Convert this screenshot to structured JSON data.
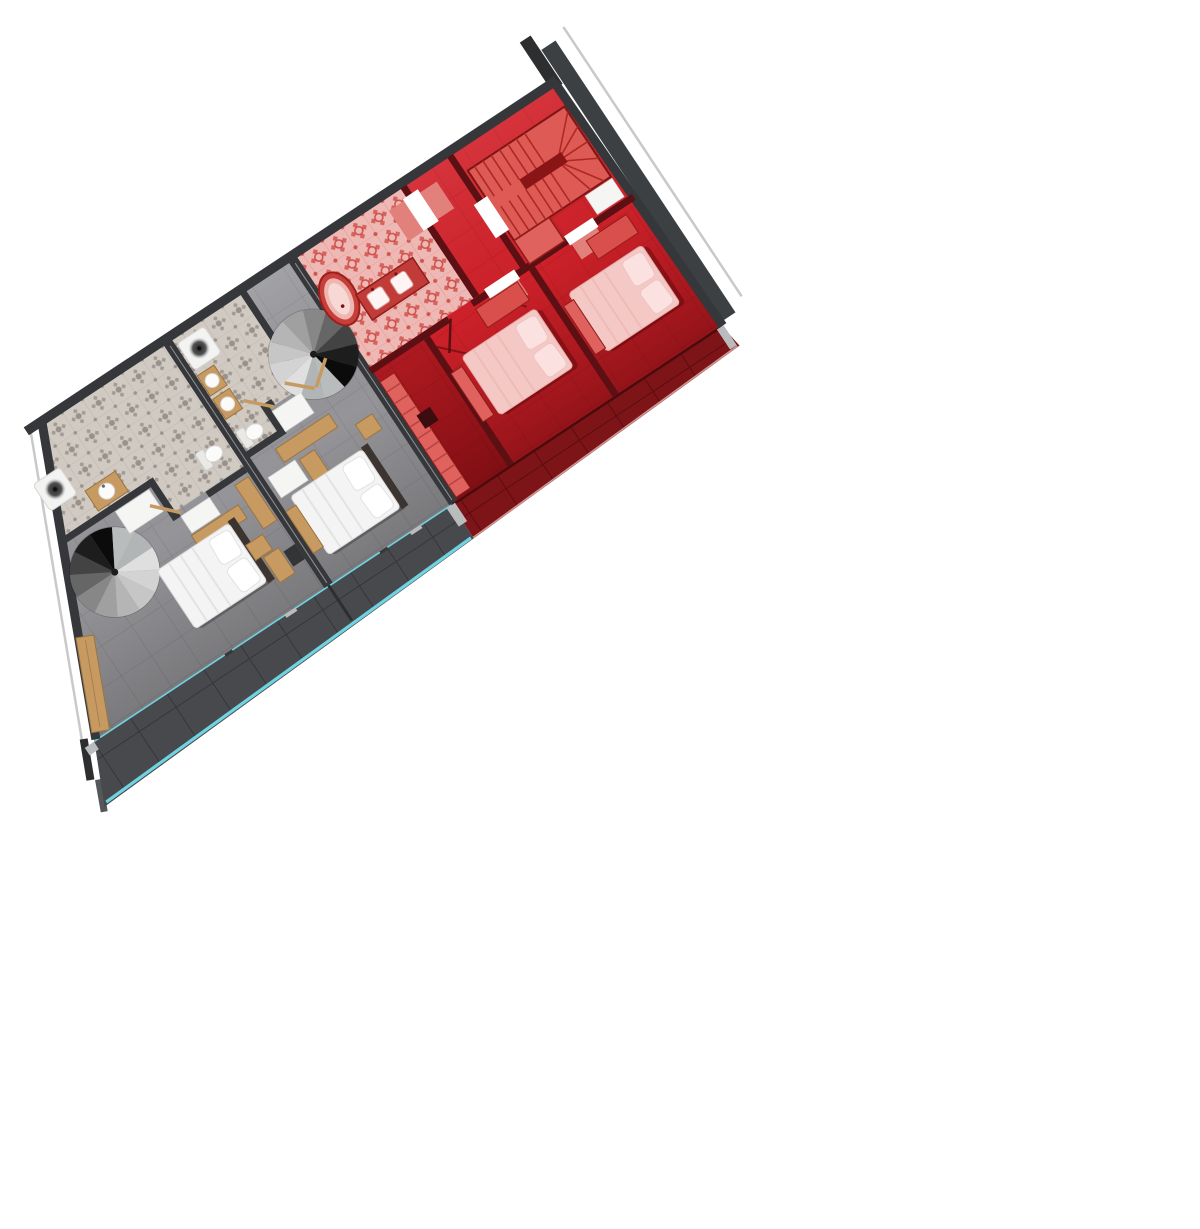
{
  "meta": {
    "kind": "architectural-floor-plan",
    "view": "top-down-render",
    "rotation_deg": -33.5,
    "description": "Rotated upper-floor plan: two gray apartments on the left, one red-highlighted apartment on the right, terraces along the lower edge"
  },
  "colors": {
    "wall": "#35373a",
    "wall_dark": "#2c2e30",
    "maroon": "#5c1013",
    "maroon_deep": "#4a0b0e",
    "gray_floor": "#98989c",
    "gray_grout": "#6f7074",
    "red_floor": "#d2222b",
    "red_grout": "#a5161c",
    "terrace_gray": "#47494c",
    "terrace_gray_grout": "#2f3133",
    "terrace_red": "#7c1418",
    "terrace_red_grout": "#55090c",
    "bath_gray_bg": "#d0cac3",
    "bath_gray_motif": "#8f8781",
    "bath_red_bg": "#eeb9b5",
    "bath_red_motif": "#cc4540",
    "cyan": "#6fd3e2",
    "wood": "#c79a62",
    "wood_dark": "#9b7440",
    "bed_white": "#f4f4f4",
    "pillow_white": "#ffffff",
    "bed_red": "#f4c8c5",
    "pillow_red": "#fbe2e0",
    "stair_red": "#dd5a55",
    "stair_red_line": "#b02824",
    "closet_red": "#e0625e",
    "mat_red": "#e2807c",
    "neighbor_wall": "#3d4043",
    "thin_line": "#c9c9c9",
    "chair_dark": "#333436",
    "post_light": "#b9bbbd"
  },
  "units": [
    {
      "id": "unit-a",
      "zone": "gray",
      "rooms": [
        "bathroom",
        "bedroom",
        "terrace"
      ],
      "furniture": [
        "shower",
        "sink-vanity",
        "toilet",
        "spiral-staircase",
        "double-bed",
        "desk",
        "chair",
        "wardrobe",
        "bench",
        "bath-mat"
      ]
    },
    {
      "id": "unit-b",
      "zone": "gray",
      "rooms": [
        "bathroom",
        "bedroom",
        "terrace"
      ],
      "furniture": [
        "shower",
        "double-sink",
        "toilet",
        "spiral-staircase",
        "double-bed",
        "desk",
        "sideboard",
        "chair",
        "bench",
        "bath-mat"
      ]
    },
    {
      "id": "unit-highlighted",
      "zone": "red",
      "rooms": [
        "bathroom",
        "hall",
        "bedroom-1",
        "bedroom-2",
        "terrace"
      ],
      "furniture": [
        "freestanding-bathtub",
        "double-vanity",
        "winder-staircase",
        "closet",
        "double-bed",
        "double-bed",
        "wardrobe",
        "bench",
        "door-mats"
      ]
    }
  ]
}
